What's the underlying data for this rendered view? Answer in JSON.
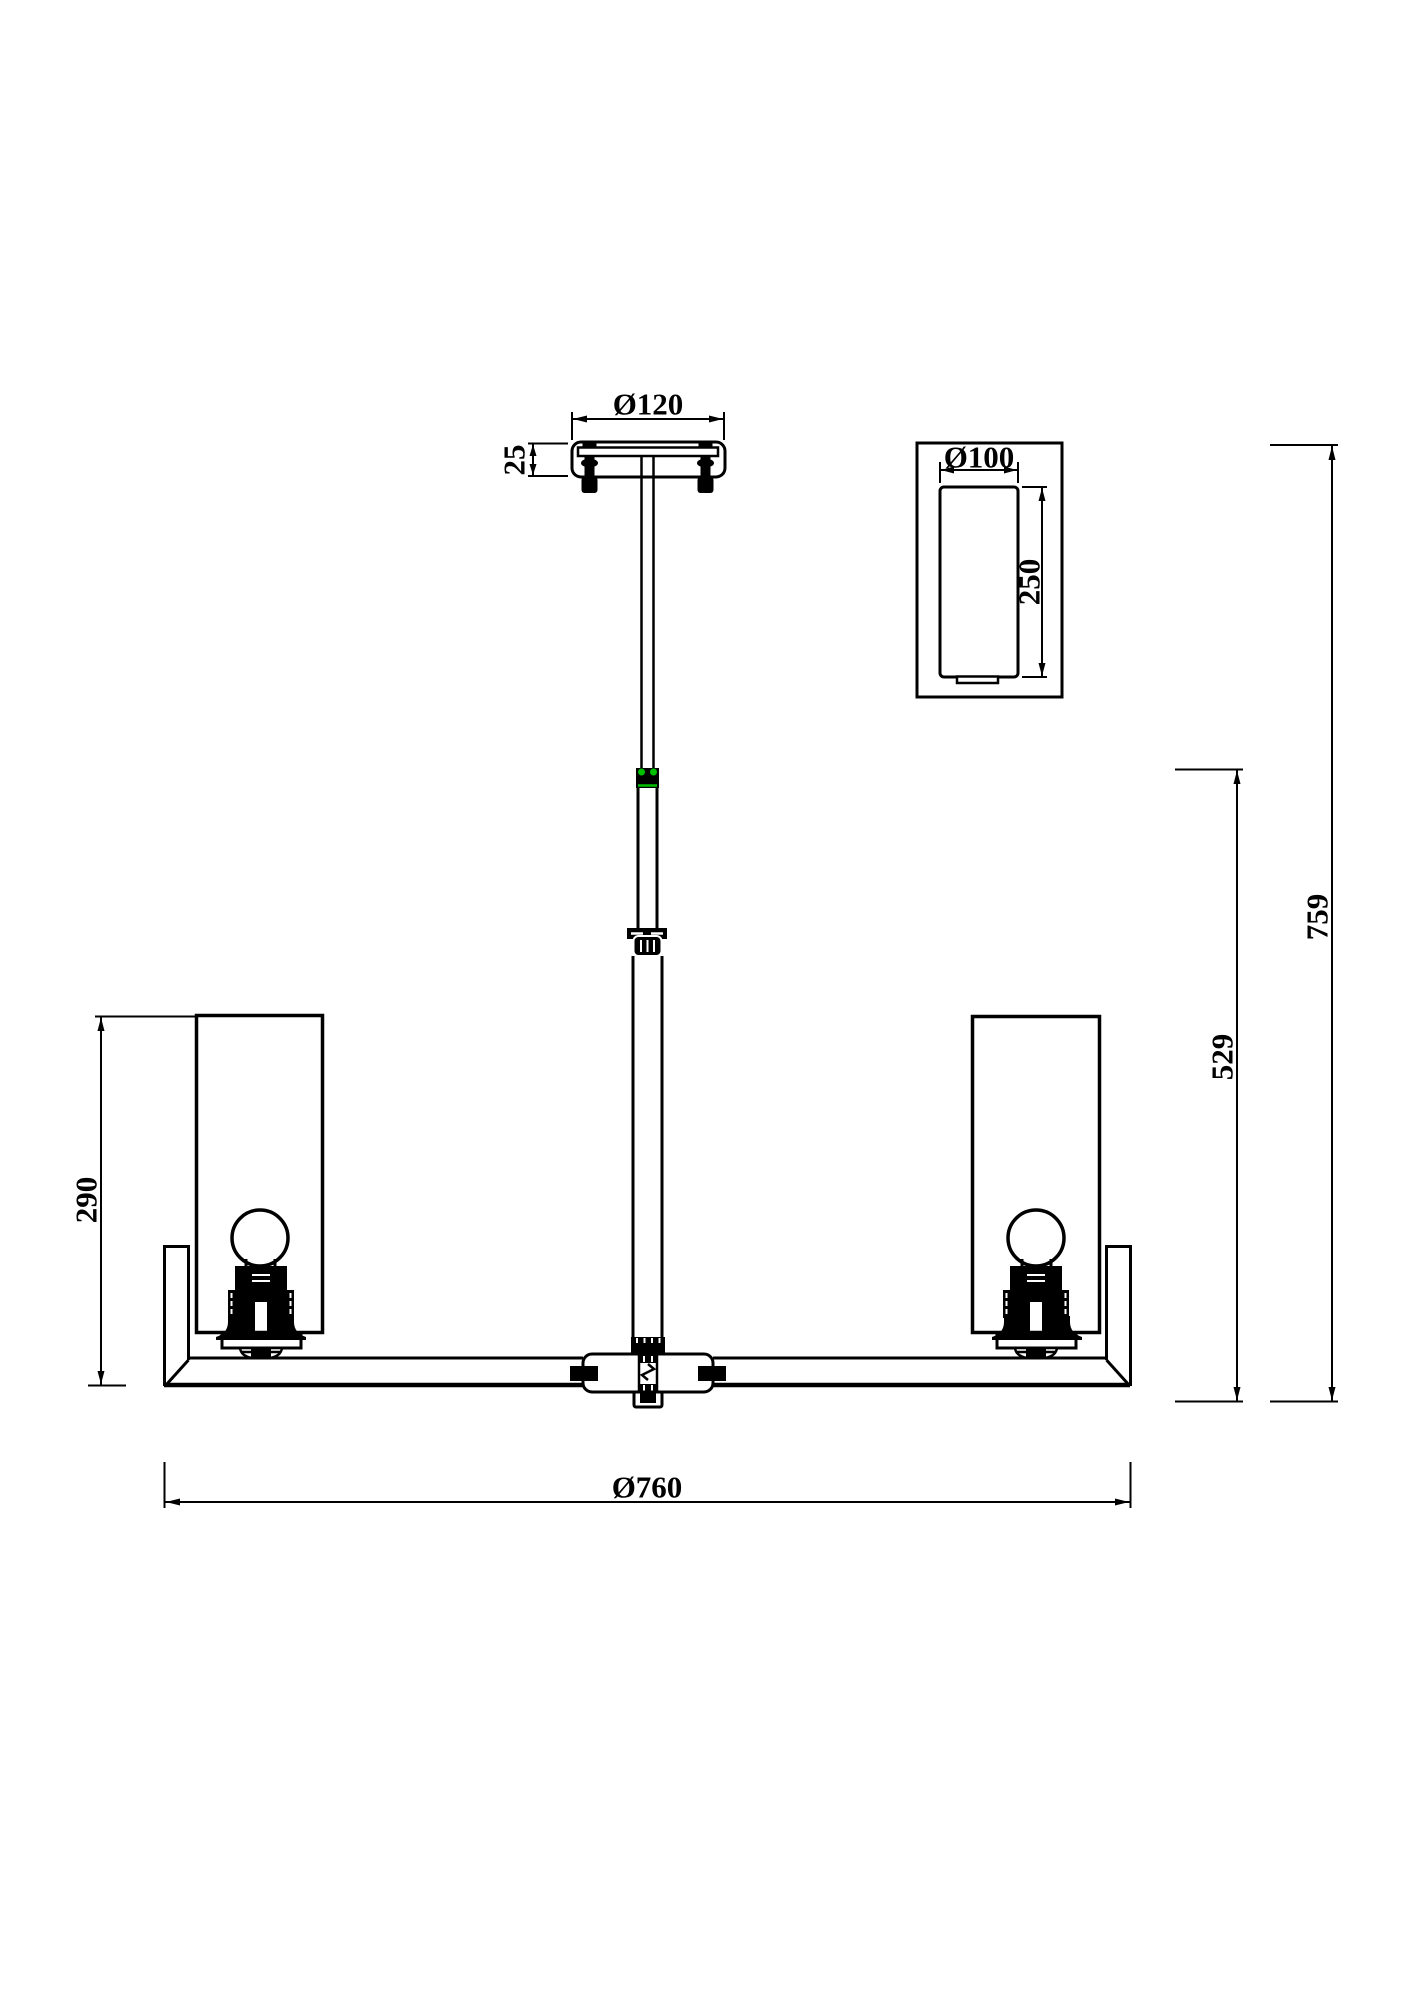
{
  "drawing": {
    "dimensions": {
      "canopy_diameter": "Ø120",
      "canopy_height": "25",
      "detail_shade_diameter": "Ø100",
      "detail_shade_height": "250",
      "overall_height": "759",
      "stem_drop_height": "529",
      "shade_height": "290",
      "fixture_diameter": "Ø760"
    },
    "colors": {
      "line": "#000000",
      "background": "#ffffff",
      "accent_green": "#00c000"
    }
  }
}
